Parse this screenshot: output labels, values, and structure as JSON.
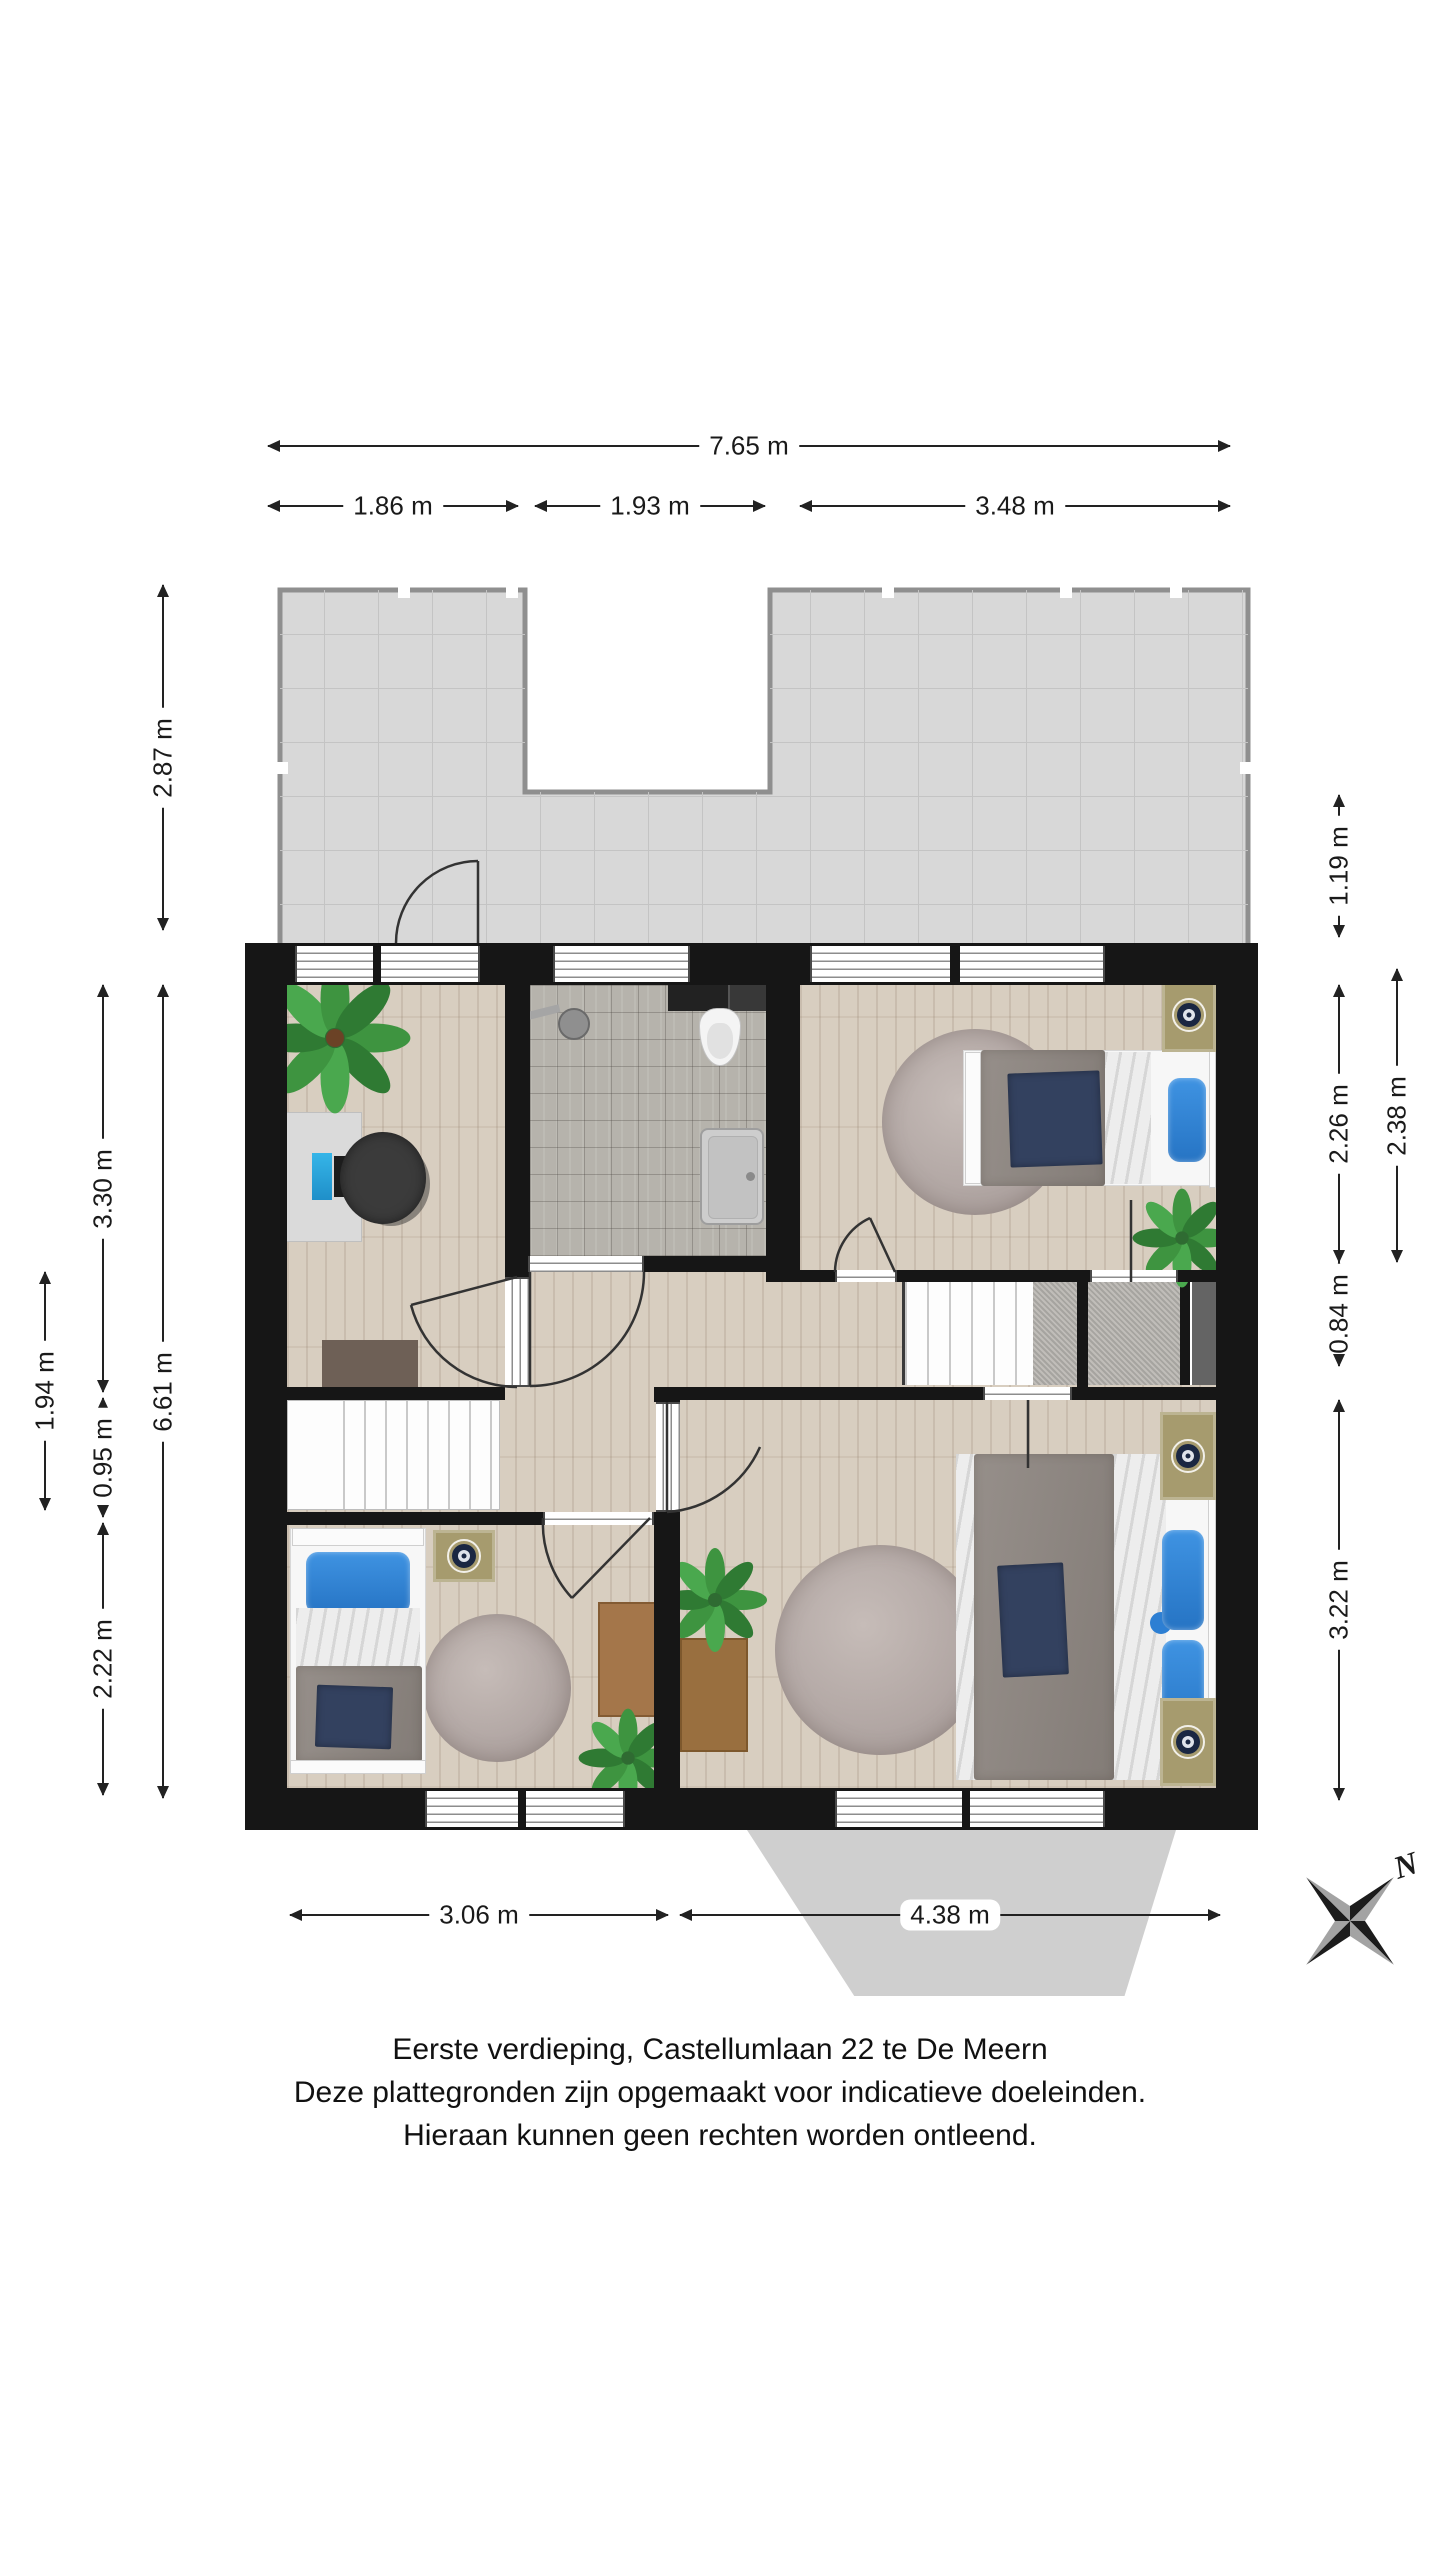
{
  "floorplan": {
    "caption": {
      "line1": "Eerste verdieping, Castellumlaan 22 te De Meern",
      "line2": "Deze plattegronden zijn opgemaakt voor indicatieve doeleinden.",
      "line3": "Hieraan kunnen geen rechten worden ontleend."
    },
    "compass": {
      "north_label": "N"
    },
    "dims": {
      "total_width": "7.65 m",
      "top_seg1": "1.86 m",
      "top_seg2": "1.93 m",
      "top_seg3": "3.48 m",
      "terrace_depth": "2.87 m",
      "floor_depth": "6.61 m",
      "office_depth": "3.30 m",
      "stairs_depth": "0.95 m",
      "bedroom_bl_depth": "2.22 m",
      "hall_depth": "1.94 m",
      "terrace_right_depth": "1.19 m",
      "bedroom_tr_depth": "2.26 m",
      "bedroom_tr_outer": "2.38 m",
      "landing_depth": "0.84 m",
      "bedroom_br_depth": "3.22 m",
      "bedroom_bl_width": "3.06 m",
      "bedroom_br_width": "4.38 m"
    }
  }
}
